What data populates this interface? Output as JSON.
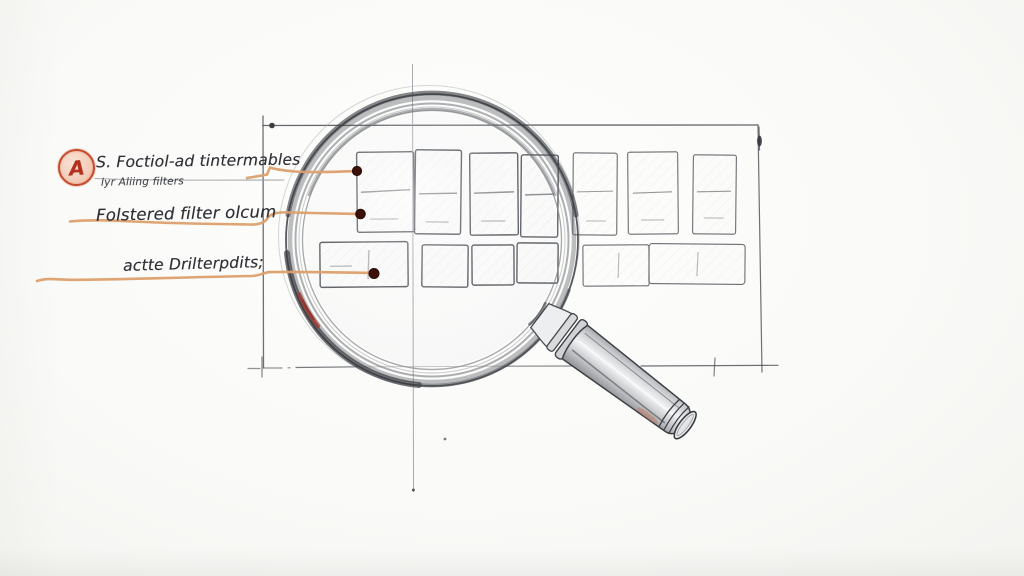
{
  "badge": {
    "letter": "A"
  },
  "annotations": [
    {
      "label": "S. Foctiol-ad tintermables",
      "sublabel": "lyr Aliing filters"
    },
    {
      "label": "Folstered filter olcum"
    },
    {
      "label": "actte Drilterpdits;"
    }
  ],
  "icons": {
    "magnifier": "magnifying-glass-sketch",
    "badge": "circled-letter-annotation"
  },
  "colors": {
    "paper": "#fafaf8",
    "pencil": "#55585e",
    "pencil_light": "#8f9196",
    "leader_orange": "#dc9f6c",
    "anchor_dot": "#3c1008",
    "badge_stroke": "#c64b2d",
    "badge_fill": "#f3cab5",
    "badge_letter": "#b42f1e",
    "accent_red": "#a5342a",
    "ink_text": "#2e2f36"
  }
}
